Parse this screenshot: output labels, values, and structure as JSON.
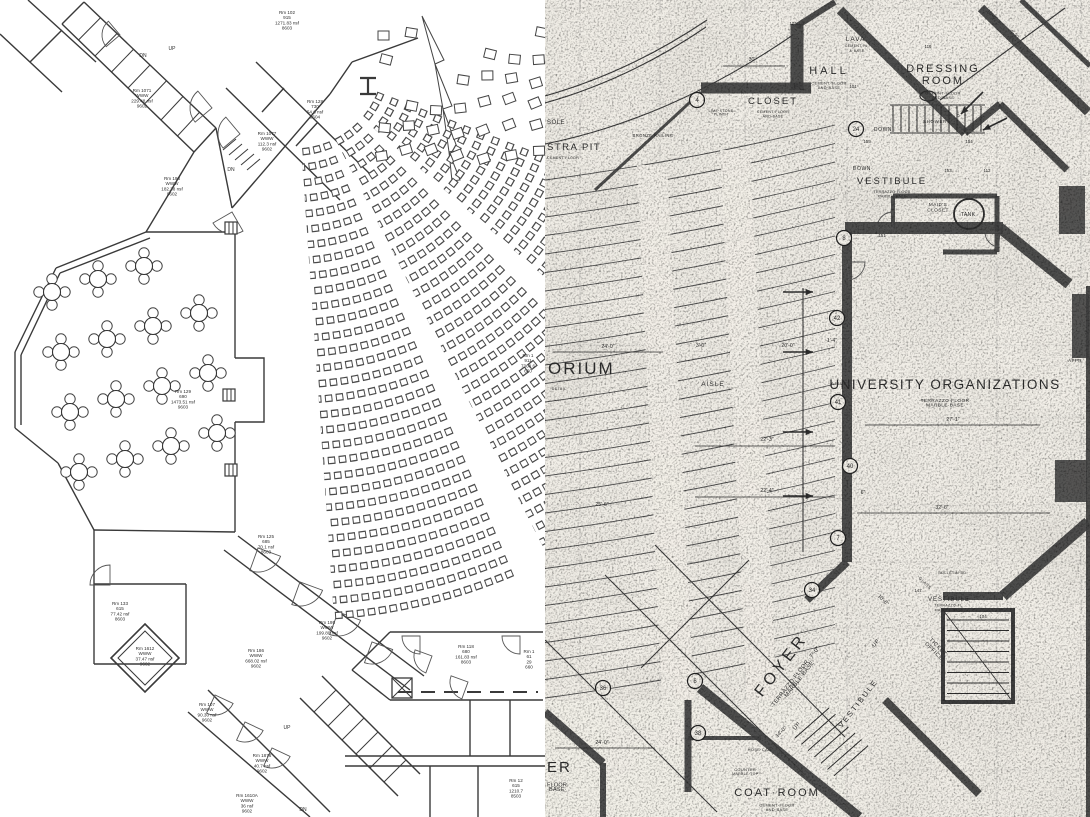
{
  "colors": {
    "left_line": "#3a3a3a",
    "right_paper": "#f2efe8",
    "right_ink": "#2e2e2e",
    "right_wall": "#3f3f3f"
  },
  "left_plan": {
    "rooms": [
      {
        "id": "rm102",
        "lines": [
          "Rm 102",
          "915",
          "1271.83 nsf",
          "8603"
        ]
      },
      {
        "id": "rm1071",
        "lines": [
          "Rm 1071",
          "WWW",
          "229.48 nsf",
          "9602"
        ]
      },
      {
        "id": "rm128",
        "lines": [
          "Rm 128",
          "730",
          "54.6 nsf",
          "9604"
        ]
      },
      {
        "id": "rm1077",
        "lines": [
          "Rm 1077",
          "WWW",
          "112.3 nsf",
          "9602"
        ]
      },
      {
        "id": "rm198",
        "lines": [
          "Rm 198",
          "WWW",
          "182.38 nsf",
          "9602"
        ]
      },
      {
        "id": "rm129",
        "lines": [
          "Rm 129",
          "690",
          "1473.51 nsf",
          "9603"
        ]
      },
      {
        "id": "rm1r",
        "lines": [
          "Rm 1",
          "911",
          "7368.6",
          "660"
        ]
      },
      {
        "id": "rm125",
        "lines": [
          "Rm 125",
          "685",
          "70.1 nsf",
          "8603"
        ]
      },
      {
        "id": "rm133",
        "lines": [
          "Rm 133",
          "615",
          "77.42 nsf",
          "8603"
        ]
      },
      {
        "id": "rm1612",
        "lines": [
          "Rm 1612",
          "WWW",
          "37.47 nsf",
          "9602"
        ]
      },
      {
        "id": "rm186",
        "lines": [
          "Rm 186",
          "WWW",
          "668.02 nsf",
          "9602"
        ]
      },
      {
        "id": "rm195",
        "lines": [
          "Rm 195",
          "WWW",
          "199.80 nsf",
          "9602"
        ]
      },
      {
        "id": "rm118",
        "lines": [
          "Rm 118",
          "680",
          "161.83 nsf",
          "8603"
        ]
      },
      {
        "id": "rm1rb",
        "lines": [
          "Rm 1",
          "61",
          "29",
          "660"
        ]
      },
      {
        "id": "rm107",
        "lines": [
          "Rm 107",
          "WWW",
          "90.30 nsf",
          "9602"
        ]
      },
      {
        "id": "rm1876",
        "lines": [
          "Rm 1876",
          "WWW",
          "40.7 nsf",
          "9602"
        ]
      },
      {
        "id": "rm1610a",
        "lines": [
          "Rm 1610A",
          "WWW",
          "36 nsf",
          "9602"
        ]
      },
      {
        "id": "rm12",
        "lines": [
          "Rm 12",
          "615",
          "1210.7",
          "8503"
        ]
      }
    ],
    "stair_labels": [
      {
        "id": "dn_top",
        "text": "DN"
      },
      {
        "id": "up_top",
        "text": "UP"
      },
      {
        "id": "dn_mid",
        "text": "DN"
      },
      {
        "id": "up_bottom",
        "text": "UP"
      },
      {
        "id": "dn_bottom",
        "text": "DN"
      }
    ]
  },
  "right_plan": {
    "labels": [
      {
        "id": "orium",
        "text": "ORIUM",
        "sub": []
      },
      {
        "id": "detail",
        "text": "DETAIL",
        "sub": []
      },
      {
        "id": "console",
        "text": "SOLE",
        "sub": []
      },
      {
        "id": "orchestra",
        "text": "STRA PIT",
        "sub": [
          "CEMENT FLOOR"
        ]
      },
      {
        "id": "bronze",
        "text": "BRONZE RAILING",
        "sub": []
      },
      {
        "id": "hall",
        "text": "HALL",
        "sub": [
          "CEMENT·FLOOR",
          "AND·BASE"
        ]
      },
      {
        "id": "closet",
        "text": "CLOSET",
        "sub": [
          "CEMENT·FLOOR",
          "AND·BASE"
        ]
      },
      {
        "id": "lava",
        "text": "LAVA.",
        "sub": [
          "CEMENT·FL.",
          "&·BASE"
        ]
      },
      {
        "id": "dressing",
        "text": "DRESSING\nROOM",
        "sub": [
          "CEMENT·FLOOR",
          "AND·BASE"
        ]
      },
      {
        "id": "shower",
        "text": "SHOWER",
        "sub": []
      },
      {
        "id": "down1",
        "text": "DOWN",
        "sub": []
      },
      {
        "id": "down2",
        "text": "DOWN·",
        "sub": []
      },
      {
        "id": "vest_top",
        "text": "VESTIBULE",
        "sub": [
          "TERRAZZO·FLOOR",
          "MARBLE·BASE"
        ]
      },
      {
        "id": "maids",
        "text": "MAID'S\nCLOSET",
        "sub": []
      },
      {
        "id": "tank",
        "text": "TANK.",
        "sub": []
      },
      {
        "id": "univ",
        "text": "UNIVERSITY ORGANIZATIONS",
        "sub": [
          "·TERRAZZO·FLOOR·",
          "·MARBLE·BASE·"
        ]
      },
      {
        "id": "aisle1",
        "text": "AISLE",
        "sub": []
      },
      {
        "id": "aisle2",
        "text": "AISLE",
        "sub": []
      },
      {
        "id": "vest_r",
        "text": "VESTIBULE",
        "sub": [
          "TERRAZZO·FL.",
          "MARBLE·BASE"
        ]
      },
      {
        "id": "ticket",
        "text": "TICKET\nOFFICE",
        "sub": []
      },
      {
        "id": "foyer",
        "text": "FOYER",
        "sub": [
          "·TERRAZZO·FLOOR··7'-0\"·",
          "·MARBLE·BASE·"
        ]
      },
      {
        "id": "vest_b",
        "text": "VESTIBULE",
        "sub": []
      },
      {
        "id": "up_b",
        "text": "UP",
        "sub": []
      },
      {
        "id": "up_b2",
        "text": "UP",
        "sub": []
      },
      {
        "id": "coat",
        "text": "COAT·ROOM",
        "sub": [
          "CEMENT·FLOOR",
          "AND·BASE"
        ]
      },
      {
        "id": "counter",
        "text": "COUNTER·",
        "sub": [
          "MARBLE·TOP·"
        ]
      },
      {
        "id": "hose",
        "text": "HOSE·CAB.",
        "sub": []
      },
      {
        "id": "foyer_part",
        "text": "ER",
        "sub": [
          "FLOOR·",
          "·BASE·"
        ]
      },
      {
        "id": "glass",
        "text": "GLASS",
        "sub": []
      },
      {
        "id": "appr",
        "text": "APPR",
        "sub": []
      },
      {
        "id": "bulletin",
        "text": "BULLETIN·BD.",
        "sub": []
      },
      {
        "id": "limestone",
        "text": "LIME·STONE",
        "sub": [
          "PLINTH"
        ]
      }
    ],
    "dimensions": [
      {
        "id": "d1",
        "text": "24'-0\""
      },
      {
        "id": "d2",
        "text": "3'-0\""
      },
      {
        "id": "d3",
        "text": "20'-0\""
      },
      {
        "id": "d4",
        "text": "22'-3\""
      },
      {
        "id": "d5",
        "text": "22'-4\""
      },
      {
        "id": "d6",
        "text": "25'-6\""
      },
      {
        "id": "d7",
        "text": "32'-6\""
      },
      {
        "id": "d8",
        "text": "27'-1\""
      },
      {
        "id": "d9",
        "text": "30'"
      },
      {
        "id": "d10",
        "text": "10'-6\""
      },
      {
        "id": "d11",
        "text": "14'-0\""
      },
      {
        "id": "d12",
        "text": "24'-0\""
      },
      {
        "id": "d13",
        "text": "16'-6\""
      },
      {
        "id": "d14",
        "text": "4'-3\""
      },
      {
        "id": "d15",
        "text": "1'-4\""
      },
      {
        "id": "d16",
        "text": "6\""
      }
    ],
    "markers": [
      {
        "id": "m4",
        "text": "4"
      },
      {
        "id": "m6",
        "text": "6"
      },
      {
        "id": "m7",
        "text": "7"
      },
      {
        "id": "m8",
        "text": "8"
      },
      {
        "id": "m24",
        "text": "24"
      },
      {
        "id": "m34",
        "text": "34"
      },
      {
        "id": "m36",
        "text": "36"
      },
      {
        "id": "m38",
        "text": "38"
      },
      {
        "id": "m40",
        "text": "40"
      },
      {
        "id": "m41",
        "text": "41"
      },
      {
        "id": "m42",
        "text": "42"
      }
    ],
    "tags": [
      {
        "id": "t101",
        "text": "101"
      },
      {
        "id": "t104",
        "text": "104"
      },
      {
        "id": "t113",
        "text": "113"
      },
      {
        "id": "t116",
        "text": "116"
      },
      {
        "id": "t124",
        "text": "124"
      },
      {
        "id": "t147",
        "text": "147"
      },
      {
        "id": "t151",
        "text": "151"
      },
      {
        "id": "t153",
        "text": "153"
      },
      {
        "id": "t154",
        "text": "154"
      },
      {
        "id": "t155",
        "text": "155"
      },
      {
        "id": "tD",
        "text": "D"
      }
    ]
  }
}
